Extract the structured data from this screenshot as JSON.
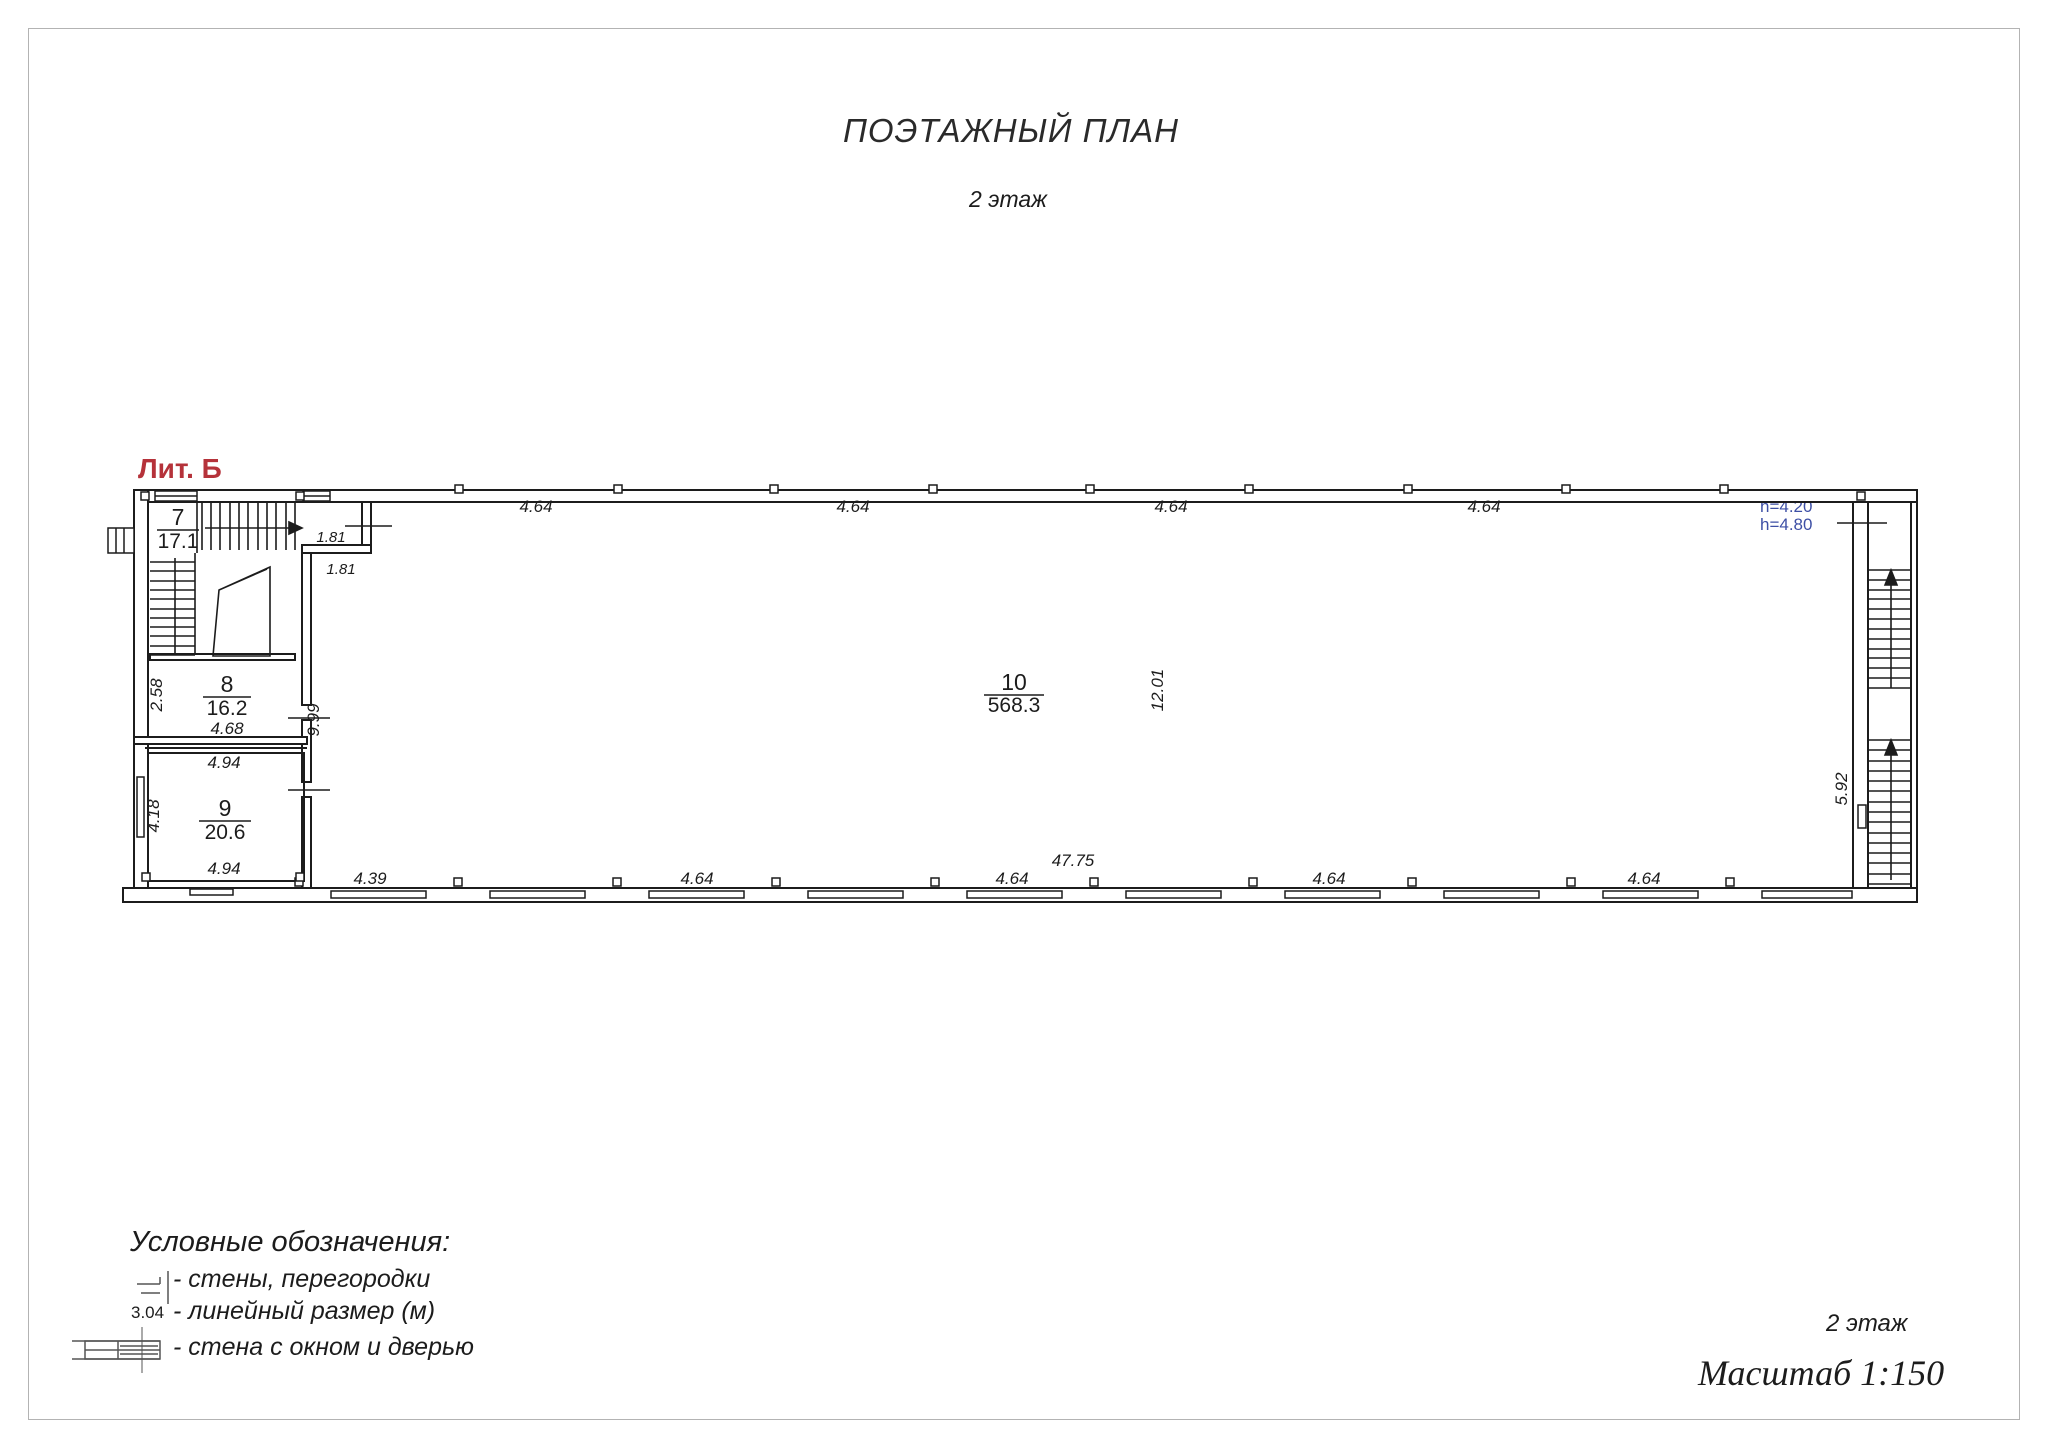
{
  "header": {
    "title": "ПОЭТАЖНЫЙ ПЛАН",
    "subtitle": "2 этаж"
  },
  "plan": {
    "liter": "Лит. Б",
    "rooms": [
      {
        "number": "7",
        "area": "17.1"
      },
      {
        "number": "8",
        "area": "16.2"
      },
      {
        "number": "9",
        "area": "20.6"
      },
      {
        "number": "10",
        "area": "568.3"
      }
    ],
    "heights": [
      "h=4.20",
      "h=4.80"
    ],
    "dims": {
      "top": [
        "4.64",
        "4.64",
        "4.64",
        "4.64"
      ],
      "step": [
        "1.81",
        "1.81"
      ],
      "bottom": [
        "4.39",
        "4.64",
        "4.64",
        "4.64",
        "4.64"
      ],
      "total": "47.75",
      "room8_width": "4.68",
      "room8_depth": "2.58",
      "room9_width_top": "4.94",
      "room9_width_bottom": "4.94",
      "room9_depth": "4.18",
      "stair_block_length": "9.99",
      "hall_depth": "12.01",
      "right_stairs_length": "5.92"
    },
    "colors": {
      "liter": "#b5323a",
      "height_note": "#3d4fa5",
      "line": "#1c1c1c"
    }
  },
  "legend": {
    "title": "Условные обозначения:",
    "items": [
      {
        "label": "- стены, перегородки"
      },
      {
        "symbol_text": "3.04",
        "label": "- линейный размер (м)"
      },
      {
        "label": "- стена с окном и дверью"
      }
    ]
  },
  "footer": {
    "floor": "2 этаж",
    "scale": "Масштаб 1:150"
  }
}
